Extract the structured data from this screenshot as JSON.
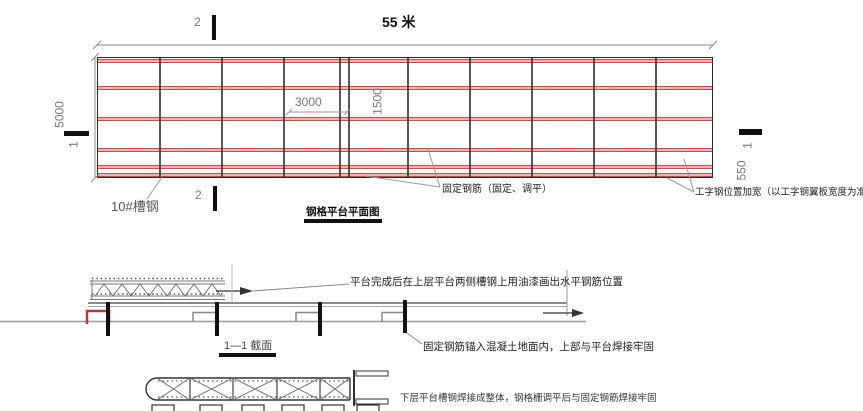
{
  "plan": {
    "title": "钢格平台平面图",
    "dims": {
      "total": "55 米",
      "height": "5000",
      "bay": "3000",
      "row": "1500",
      "edge": "550"
    },
    "markers": {
      "one": "1",
      "two": "2"
    },
    "labels": {
      "channel": "10#槽钢",
      "rebar": "固定钢筋（固定、调平）",
      "ibeam": "工字钢位置加宽（以工字钢翼板宽度为准）"
    }
  },
  "section": {
    "title": "1—1 截面",
    "note_paint": "平台完成后在上层平台两侧槽钢上用油漆画出水平钢筋位置",
    "note_anchor": "固定钢筋锚入混凝土地面内，上部与平台焊接牢固"
  },
  "lower": {
    "note": "下层平台槽钢焊接成整体，钢格栅调平后与固定钢筋焊接牢固"
  },
  "colors": {
    "red": "#c05050",
    "pink": "#f2b2b2",
    "line": "#3a3a3a"
  }
}
